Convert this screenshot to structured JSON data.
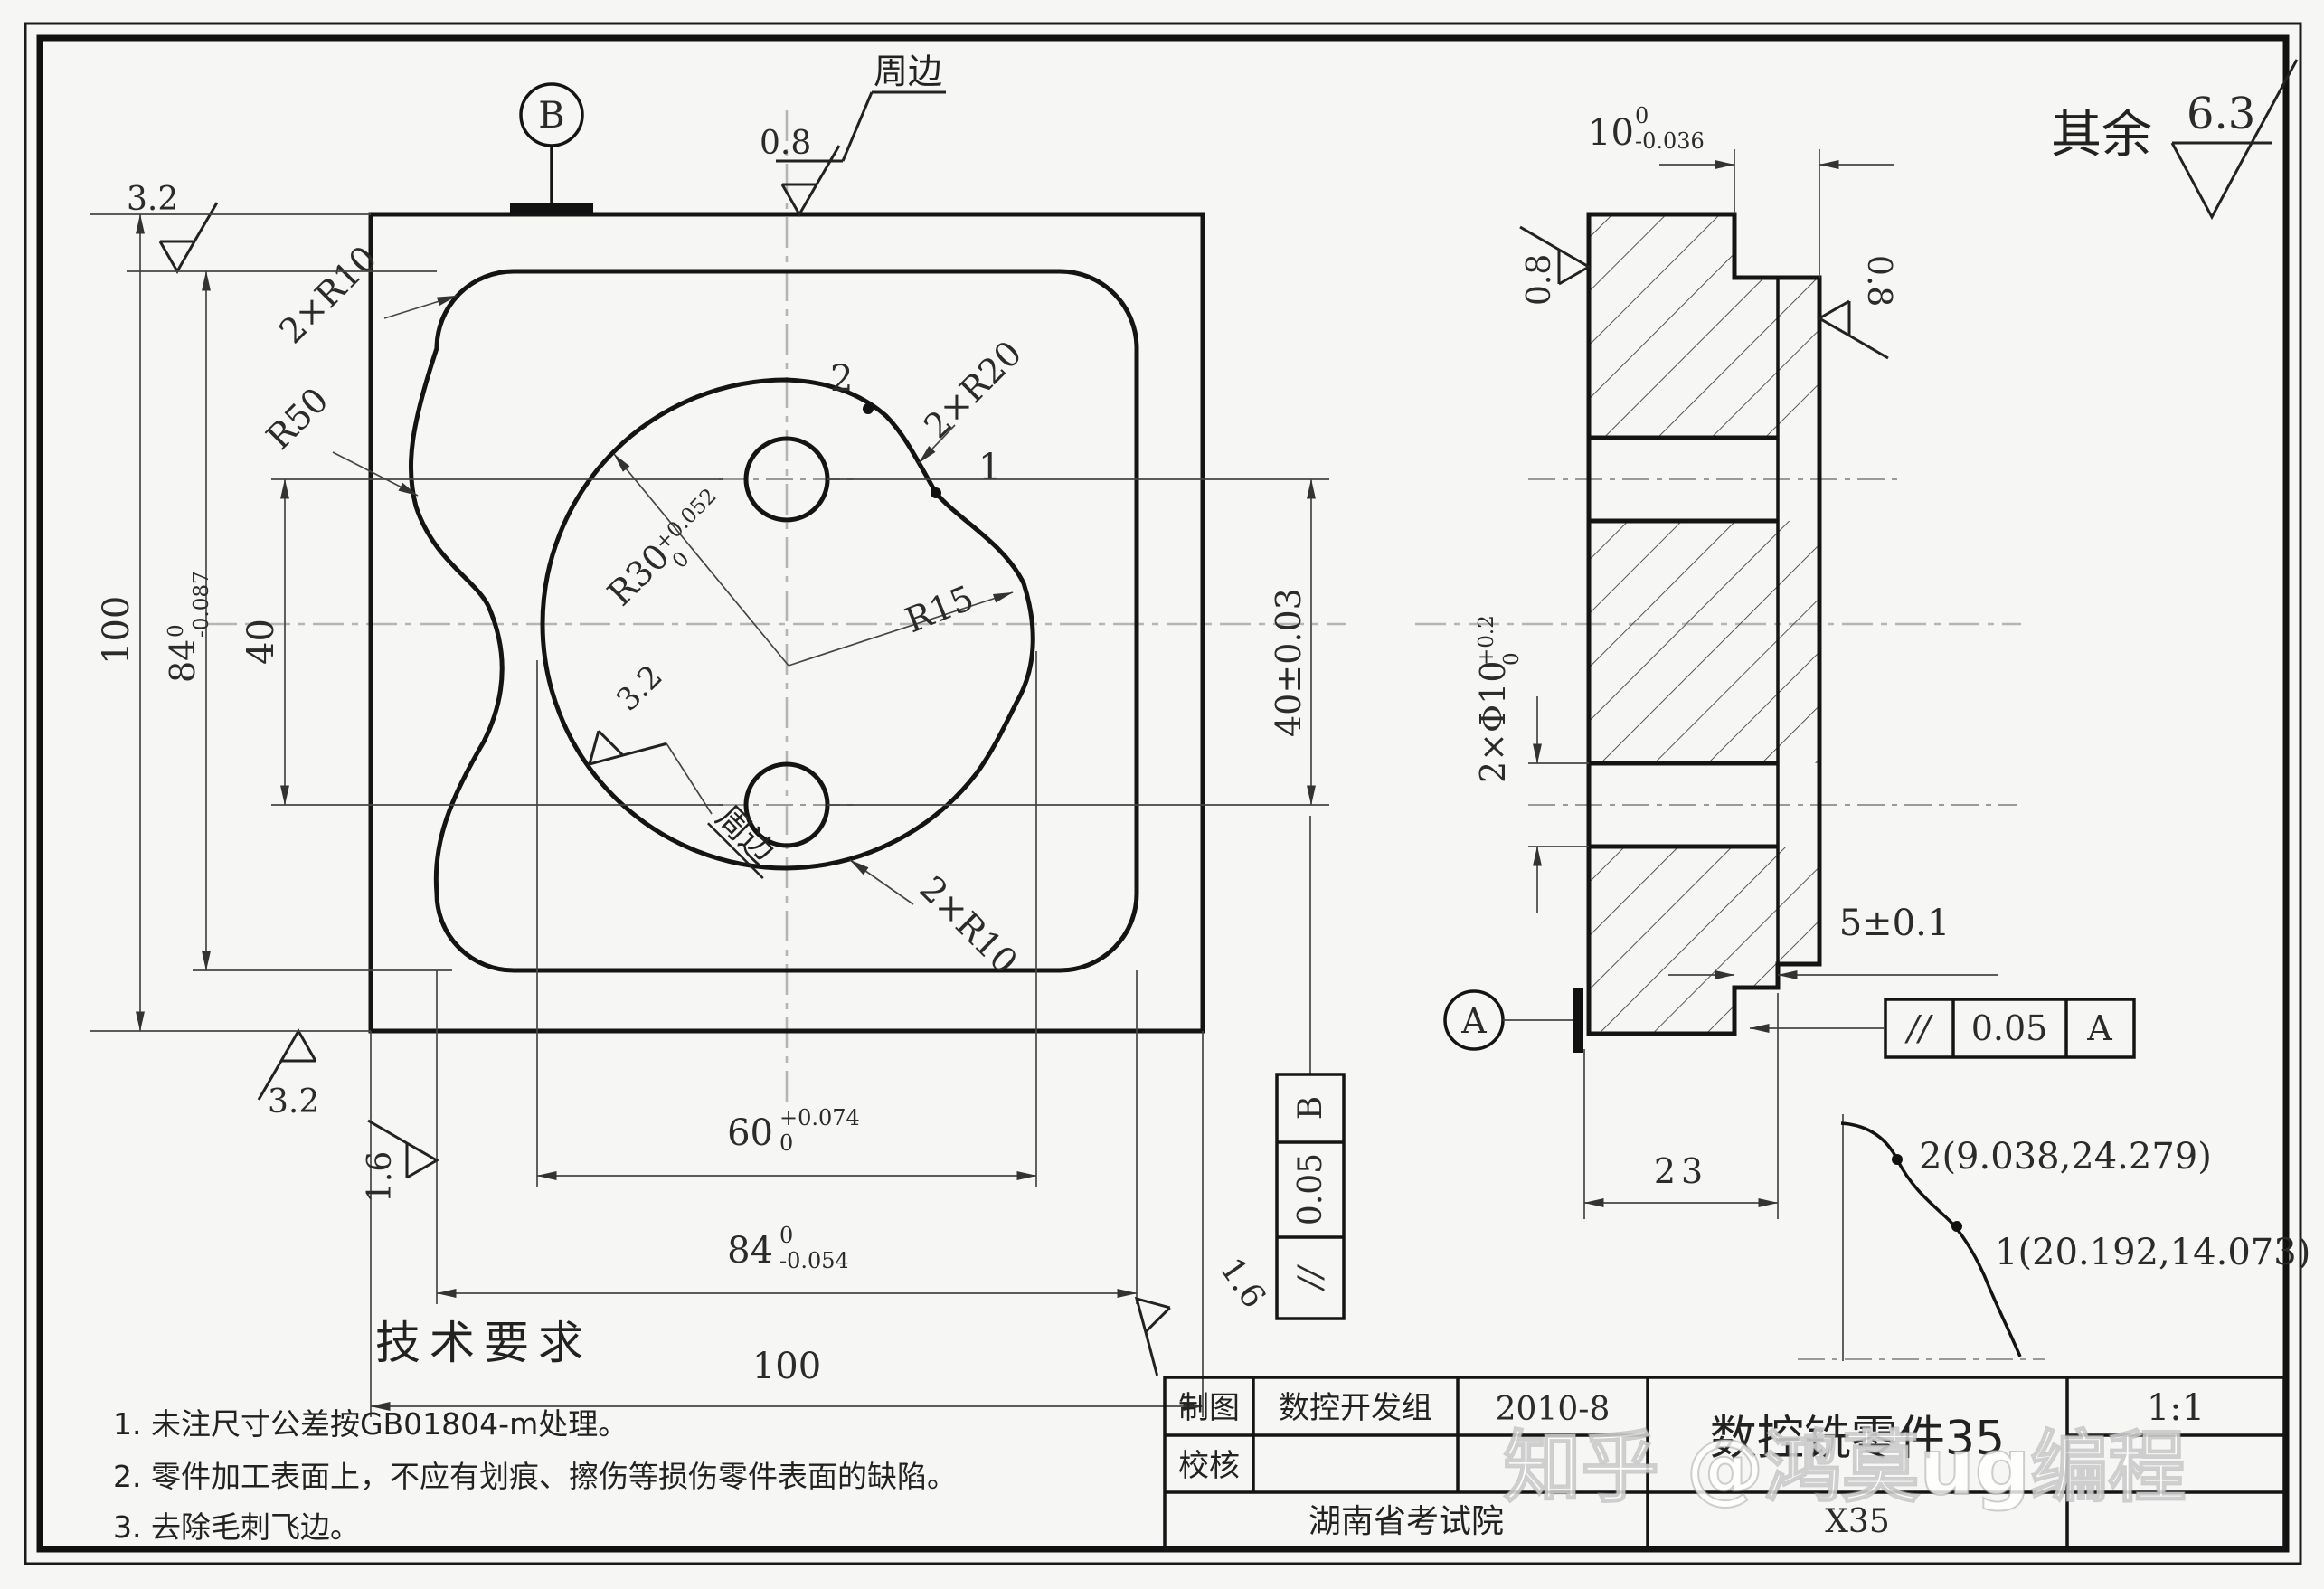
{
  "sheet": {
    "rest_label": "其余",
    "rest_value": "6.3"
  },
  "main_view": {
    "datum_b": "B",
    "sf_32_top": "3.2",
    "sf_08_top": "0.8",
    "zone_top": "周边",
    "r10_top": "2×R10",
    "r50": "R50",
    "r30": "R30",
    "r30_sup": "+0.052",
    "r30_sub": "0",
    "r20": "2×R20",
    "r15": "R15",
    "pt2": "2",
    "pt1": "1",
    "sf_inner": "3.2",
    "zone_inner": "周边",
    "r10_bottom": "2×R10",
    "dim_100_left": "100",
    "dim_84_left": "84",
    "dim_84_left_sup": "0",
    "dim_84_left_sub": "-0.087",
    "dim_40_left": "40",
    "dim_40_right": "40±0.03",
    "dim_60": "60",
    "dim_60_sup": "+0.074",
    "dim_60_sub": "0",
    "dim_84_bottom": "84",
    "dim_84_bottom_sup": "0",
    "dim_84_bottom_sub": "-0.054",
    "dim_100_bottom": "100",
    "sf_32_bottom": "3.2",
    "sf_16_left": "1.6",
    "sf_16_right": "1.6",
    "fcf_b": {
      "sym": "//",
      "tol": "0.05",
      "datum": "B"
    }
  },
  "section_view": {
    "dim_10": "10",
    "dim_10_sup": "0",
    "dim_10_sub": "-0.036",
    "sf_left": "0.8",
    "sf_right": "0.8",
    "dim_holes": "2×Φ10",
    "dim_holes_sup": "+0.2",
    "dim_holes_sub": "0",
    "dim_5": "5±0.1",
    "dim_23": "23",
    "datum_a": "A",
    "fcf_a": {
      "sym": "//",
      "tol": "0.05",
      "datum": "A"
    },
    "pt2_coord": "2(9.038,24.279)",
    "pt1_coord": "1(20.192,14.073)"
  },
  "notes": {
    "heading": "技术要求",
    "items": [
      "1. 未注尺寸公差按GB01804-m处理。",
      "2. 零件加工表面上，不应有划痕、擦伤等损伤零件表面的缺陷。",
      "3. 去除毛刺飞边。"
    ]
  },
  "title_block": {
    "drafter_label": "制图",
    "drafter": "数控开发组",
    "date": "2010-8",
    "checker_label": "校核",
    "org": "湖南省考试院",
    "title": "数控铣零件35",
    "scale": "1:1",
    "part_no": "X35"
  },
  "watermark": "知乎 @鸿莫ug编程"
}
